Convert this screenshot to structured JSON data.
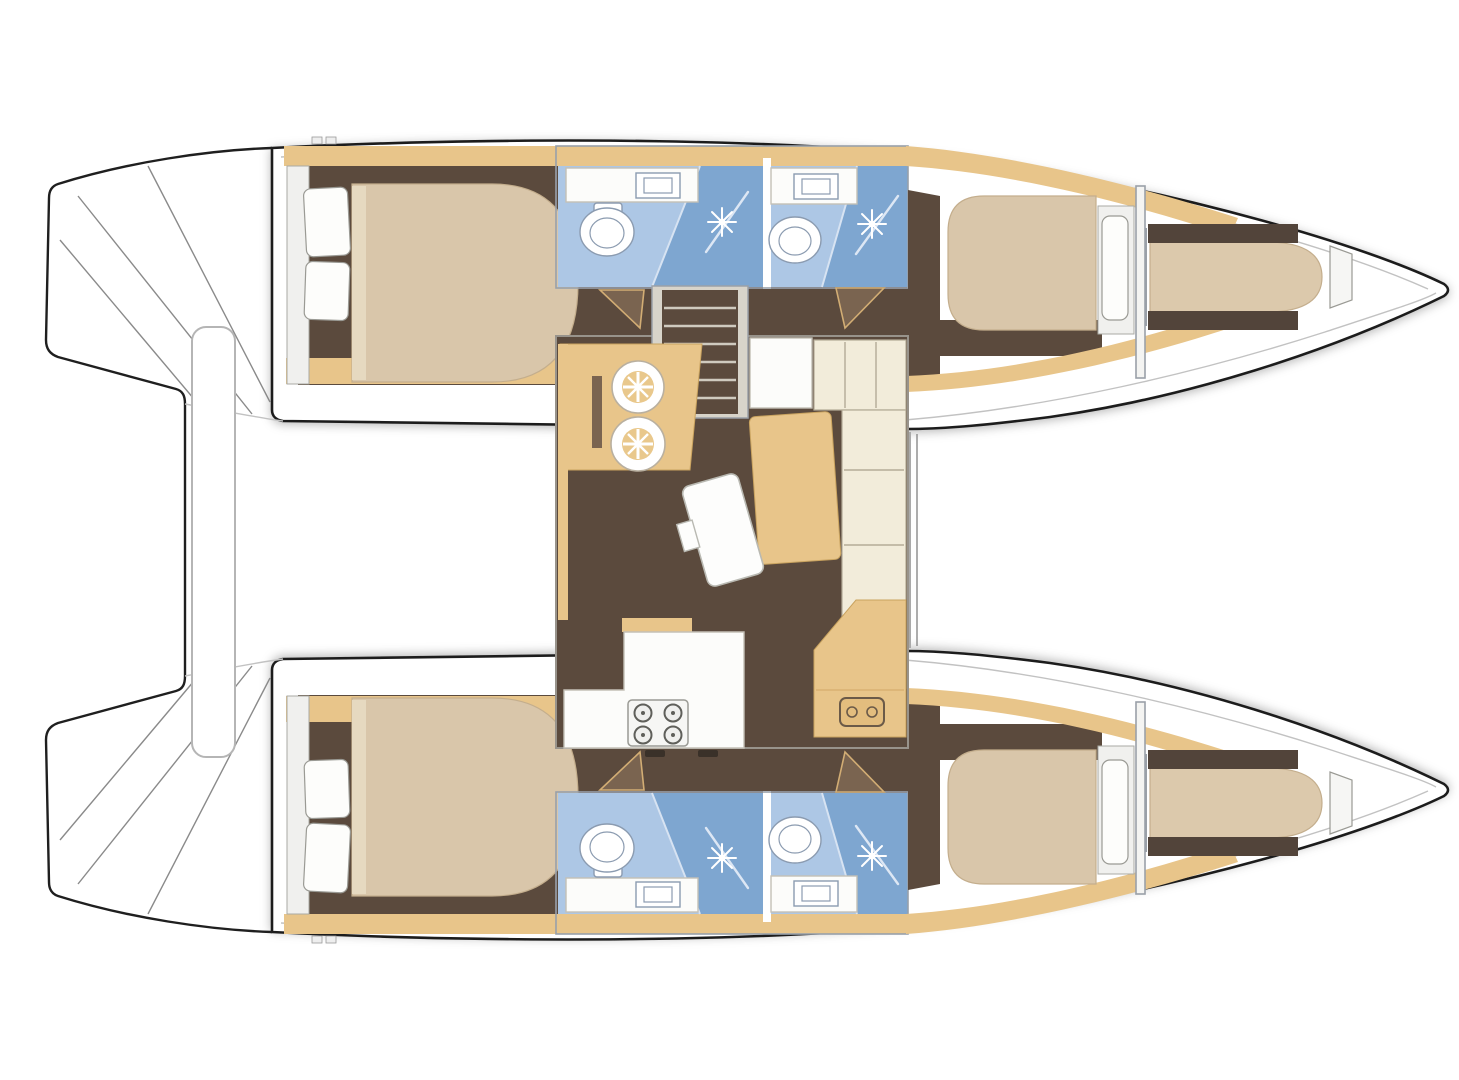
{
  "title": "Catamaran interior deck floor plan, top view, bows pointing right",
  "vessel": {
    "type": "sailing-catamaran",
    "view": "interior-layout-top-view",
    "orientation": "bows-right-sterns-left",
    "cabins": 4,
    "bathrooms": 4,
    "forepeak_berths": 2
  },
  "rooms": {
    "port_hull": [
      "aft-double-cabin",
      "aft-bathroom-with-shower",
      "forward-bathroom-with-shower",
      "forward-double-cabin",
      "forepeak-berth"
    ],
    "starboard_hull": [
      "aft-double-cabin",
      "aft-bathroom-with-shower",
      "forward-bathroom-with-shower",
      "forward-double-cabin",
      "forepeak-berth"
    ],
    "bridgedeck_salon": [
      "nav-desk-with-twin-sinks",
      "companionway-stairs",
      "l-shaped-sofa",
      "dining-table",
      "galley-counter-with-stove",
      "aft-cabinet"
    ]
  },
  "icons": [
    "toilet-icon",
    "sink-icon",
    "shower-spray-icon",
    "stove-burner-icon",
    "stairs-icon",
    "pillow-icon"
  ],
  "colors": {
    "hull_outline": "#1f1f1f",
    "floor_brown": "#5b4a3d",
    "floor_brown_dark": "#52443a",
    "wood_tan": "#e8c58a",
    "wood_edge": "#c9a35f",
    "mattress_beige": "#d9c6aa",
    "mattress_edge": "#c4ae8d",
    "sofa_cream": "#f2ecda",
    "bath_blue": "#adc7e5",
    "shower_blue": "#7ea6d0",
    "wall_gray": "#98a0aa",
    "deck_white": "#ffffff"
  }
}
